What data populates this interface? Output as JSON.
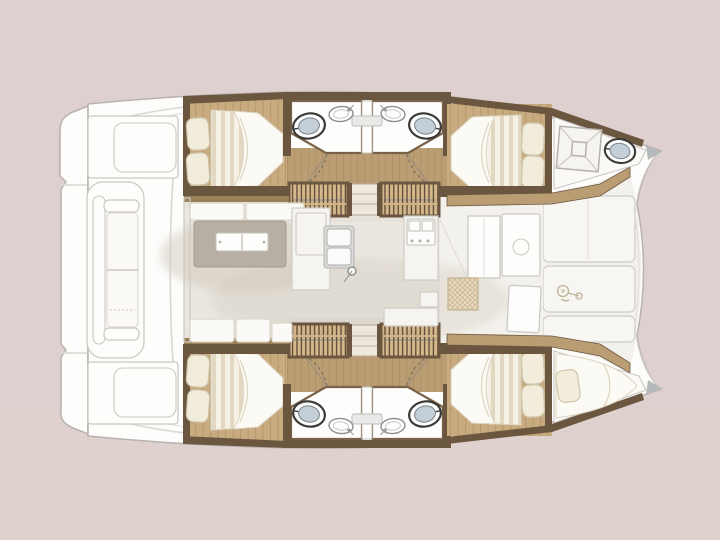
{
  "meta": {
    "title": "Catamaran interior layout floor plan (top view)",
    "view": "top-down deck plan",
    "text_on_screen": "none"
  },
  "colors": {
    "bg": "#ded0cf",
    "bgWarm": "#e2d3ca",
    "hullWhite": "#fdfdfc",
    "outlineGray": "#b8b1af",
    "panelLine": "#cdc9c3",
    "cockpitCurve": "#dcd7d2",
    "deckPanel": "#f8f6f2",
    "salonFloor": "#ebe7e0",
    "fwdFloor": "#f3f1ec",
    "salonShadow": "#cdc5b6",
    "woodLight": "#c9ab80",
    "woodMid": "#bb9d73",
    "grainLine": "#a5875e",
    "trimDark": "#6b5740",
    "trimTan": "#9c8259",
    "stairFill": "#d4b88c",
    "stairLine": "#4e3c28",
    "stairSeam": "#51618b",
    "stepFill": "#efe9dd",
    "stepLine": "#b5ad9f",
    "mattress": "#f5f1e4",
    "stripe": "#ded3ba",
    "duvet": "#fcfaf4",
    "duvetLine": "#ddd5c1",
    "pillow": "#f2ecdb",
    "pillowLine": "#cfc5ab",
    "wallBrown": "#7a6248",
    "fixtureWhite": "#fdfdfc",
    "consoleGray": "#e9e9e7",
    "toiletRim": "#3a3a38",
    "toiletLid": "#c4ced6",
    "toiletInnerLine": "#76828c",
    "sinkStroke": "#8f8f8d",
    "dashLine": "#5a5a58",
    "table": "#b7afa3",
    "tableLine": "#a39b8f",
    "tray": "#fdfdfb",
    "trayLine": "#c9c4bb",
    "seat": "#fbfaf6",
    "seatLine": "#dcd7cc",
    "counter": "#f5f4f0",
    "counterLine": "#cfccc5",
    "appliance": "#d9d9d7",
    "applianceLine": "#b9b9b7",
    "mat": "#e8dabf",
    "matLine": "#c6b28f",
    "tipGray": "#b6b9bb",
    "windlassLine": "#c0b296",
    "shadowColor": "#4a3f32"
  },
  "labels": {
    "boat": "Catamaran floor plan, top view",
    "sternPlatform": "Stern swim platform with steps",
    "transomLocker": "Transom locker",
    "aftBench": "Aft cockpit bench with cushions",
    "cockpit": "Aft cockpit deck",
    "salon": "Salon floor",
    "slidingDoor": "Salon sliding door",
    "salonTable": "Salon dining table",
    "salonTray": "Table tray",
    "salonSeats": "Salon bench seating",
    "galleyIsland": "Galley island counter",
    "galleySink": "Galley double sink",
    "faucet": "Galley faucet",
    "stove": "Stove with burners",
    "tallUnit": "Galley tall cabinet",
    "counterAft": "Galley aft counter",
    "navCabinet": "Forward cabinet",
    "fwdDoor": "Forward cockpit door",
    "fwdDoor2": "Forward cockpit second door",
    "mat": "Woven entry mat",
    "foredeck": "Foredeck panels",
    "windlass": "Anchor windlass",
    "hullTop": "Starboard hull interior",
    "hullBottom": "Port hull interior (mirrored)",
    "aftCabin": "Aft double cabin",
    "fwdCabin": "Forward double cabin",
    "bed": "Double bed with duvet",
    "pillow": "Pillow",
    "bathrooms": "Twin bathrooms",
    "toilet": "Toilet",
    "washbasin": "Washbasin",
    "doorSwing": "Door swing arc",
    "stairs": "Companionway stairs to hull",
    "midSteps": "Entry steps",
    "corridor": "Hull corridor",
    "forepeakHead": "Bow compartment with hatch and toilet",
    "deckHatch": "Deck hatch",
    "forepeakBerth": "Bow single berth",
    "bowTip": "Bow tip"
  }
}
